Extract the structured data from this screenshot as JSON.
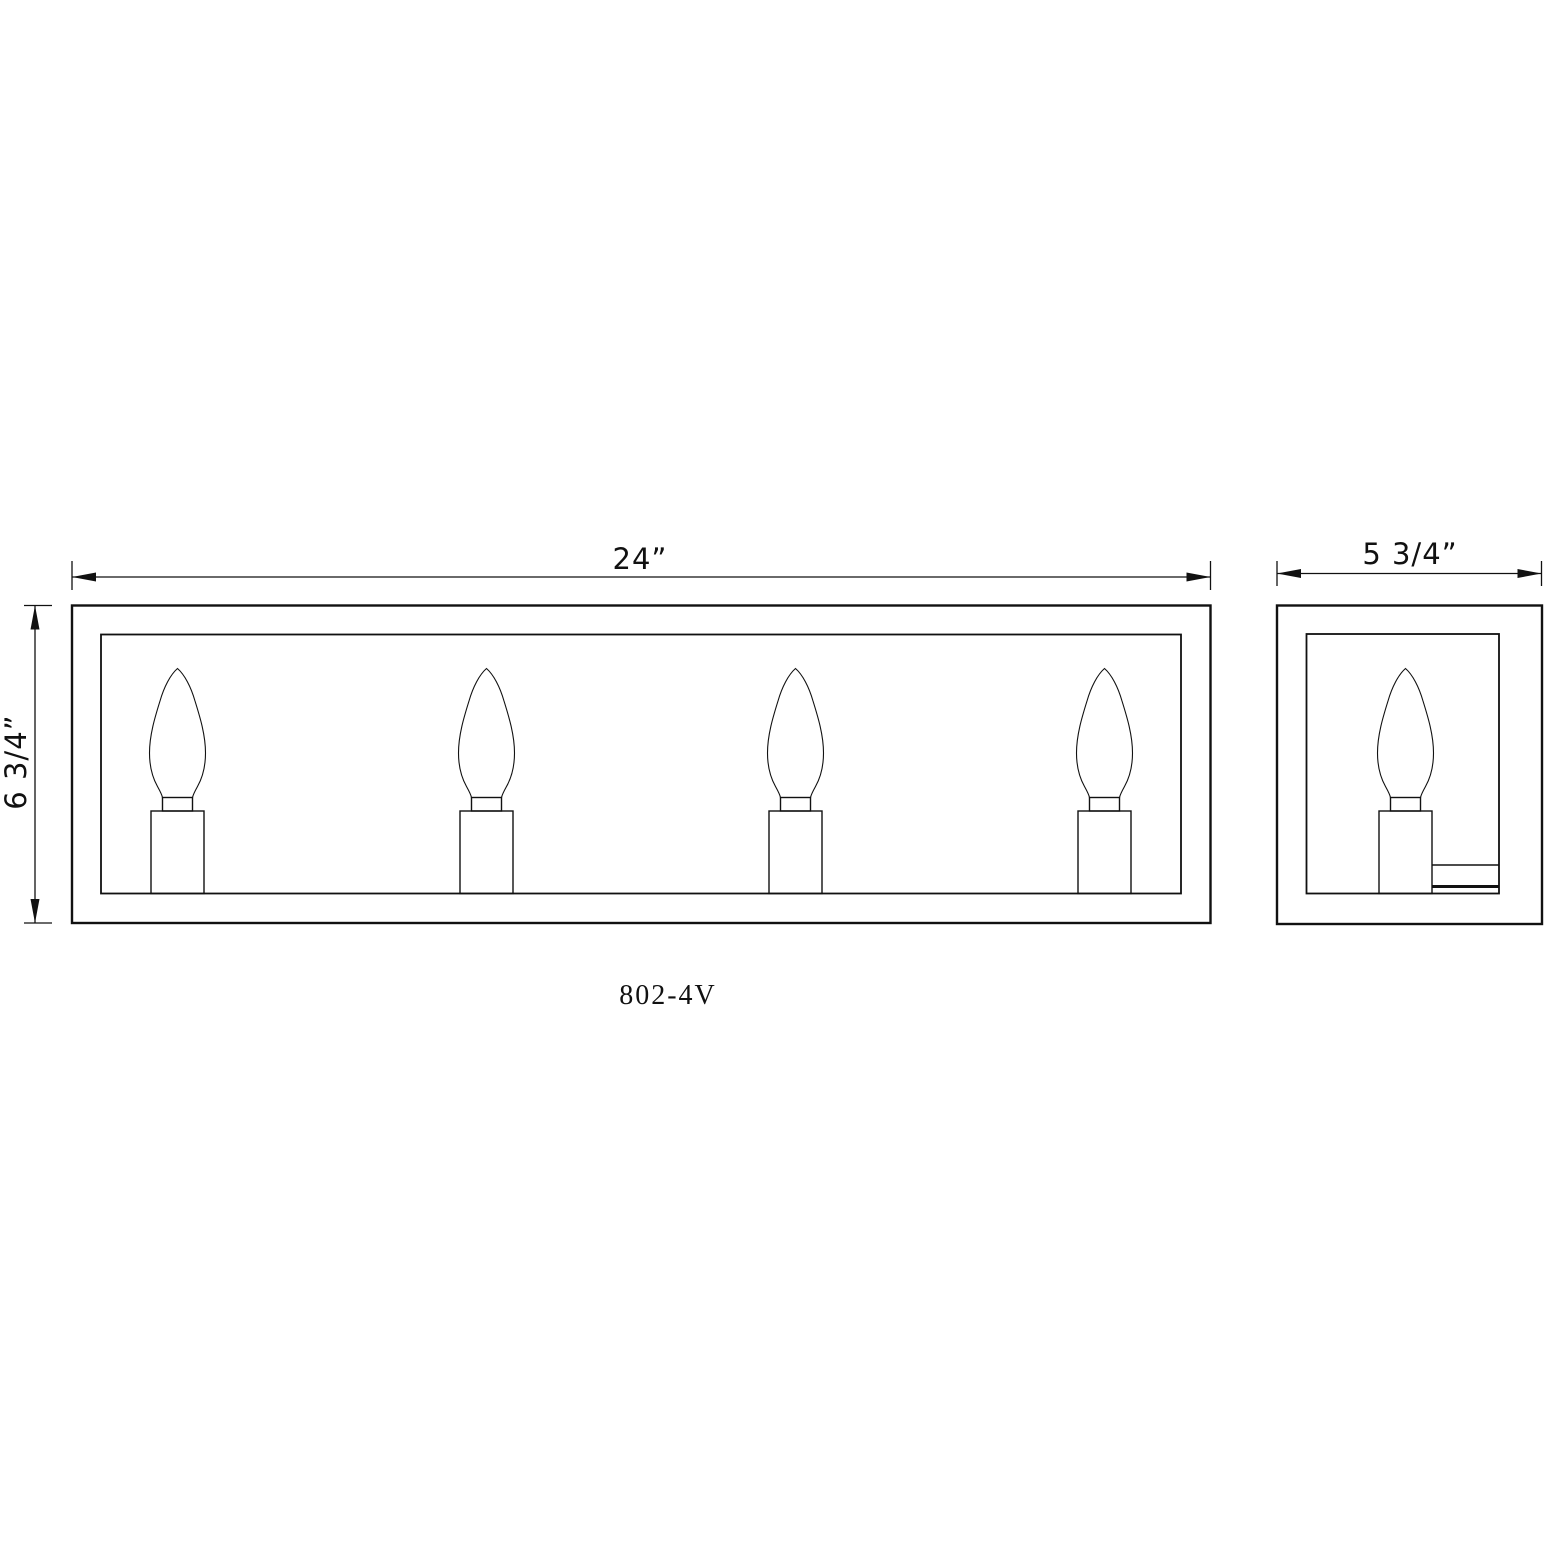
{
  "page": {
    "background": "#ffffff",
    "line_color": "#111111"
  },
  "drawing": {
    "model_label": "802-4V",
    "dimension_width": "24”",
    "dimension_height": "6 3/4”",
    "dimension_depth": "5 3/4”",
    "front_view_lamp_count": 4,
    "side_view_lamp_count": 1
  }
}
